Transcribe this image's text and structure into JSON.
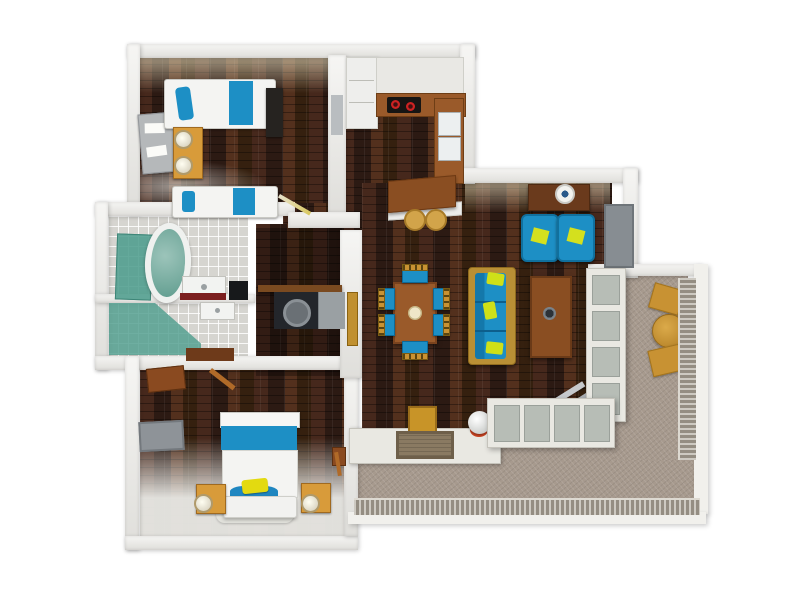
{
  "scene": {
    "type": "3d-rendered-floor-plan",
    "view": "top-down",
    "background": "#ffffff"
  },
  "palette": {
    "wood": "#38221a",
    "plank1": "#46281c",
    "plank2": "#2c1a13",
    "plank3": "#53301d",
    "wall": "#edece8",
    "blue": "#1d8fc5",
    "yellow": "#d4e01e",
    "teal": "#4f9d8d",
    "woodfurn": "#9a5a2a",
    "wooddark": "#6a3a1c",
    "orange": "#d89b3a",
    "gold": "#c89233",
    "tile": "#d6d5d0",
    "terrace": "#a79a8e",
    "red": "#cc2222",
    "counterred": "#7c1f1f",
    "grey": "#8e9398",
    "white": "#f4f4f2"
  },
  "rooms": [
    {
      "name": "bedroom-small",
      "floor": "dark-wood",
      "furniture": [
        "twin-bed",
        "twin-bed",
        "nightstand",
        "table-lamp",
        "table-lamp",
        "desk",
        "wardrobe",
        "open-door"
      ]
    },
    {
      "name": "kitchen",
      "floor": "dark-wood",
      "furniture": [
        "tall-cabinet",
        "upper-cabinets",
        "cooktop-two-burners",
        "double-sink-counter",
        "island-counter",
        "bar-stool",
        "bar-stool"
      ]
    },
    {
      "name": "bathroom",
      "floor": "tile",
      "furniture": [
        "bathtub",
        "shower-glass",
        "shower-glass",
        "vanity-sink",
        "sink",
        "dark-cabinet"
      ]
    },
    {
      "name": "laundry-closet",
      "floor": "dark-wood",
      "furniture": [
        "shelf",
        "washing-machine",
        "cabinet",
        "closet-door"
      ]
    },
    {
      "name": "living-dining-room",
      "floor": "dark-wood",
      "furniture": [
        "dining-table",
        "dining-chair",
        "dining-chair",
        "dining-chair",
        "dining-chair",
        "dining-chair",
        "dining-chair",
        "sofa",
        "coffee-table",
        "console-desk",
        "wall-clock",
        "armchair",
        "armchair",
        "tv-panel",
        "storage-box",
        "decor-sphere",
        "folding-chair",
        "doormat"
      ]
    },
    {
      "name": "bedroom-master",
      "floor": "dark-wood",
      "furniture": [
        "double-bed",
        "yellow-pillow",
        "nightstand",
        "nightstand",
        "table-lamp",
        "table-lamp",
        "tv-panel",
        "wall-cabinet",
        "wall-cabinet",
        "wall-cabinet",
        "rug",
        "open-door"
      ]
    },
    {
      "name": "balcony",
      "floor": "stone",
      "furniture": [
        "round-table",
        "patio-chair",
        "patio-chair",
        "railing",
        "window-wall"
      ]
    },
    {
      "name": "terrace",
      "floor": "stone",
      "furniture": [
        "railing",
        "window-wall",
        "ledge"
      ]
    }
  ]
}
